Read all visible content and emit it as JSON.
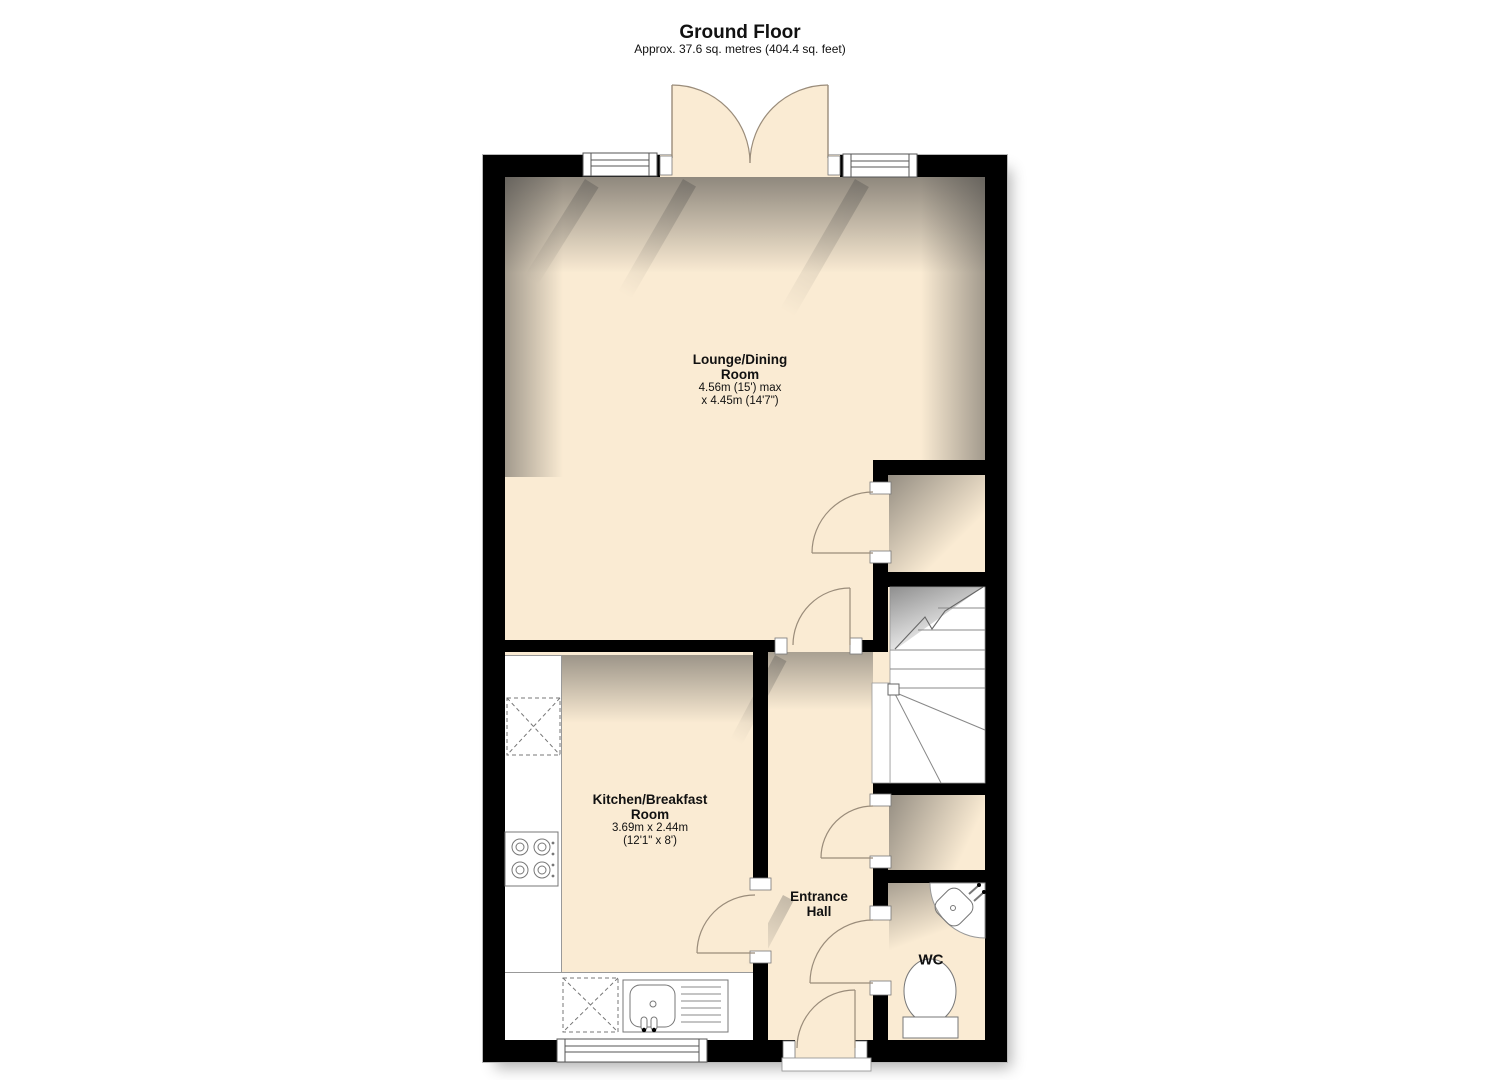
{
  "title": "Ground Floor",
  "subtitle": "Approx. 37.6 sq. metres (404.4 sq. feet)",
  "rooms": {
    "lounge": {
      "name_line1": "Lounge/Dining",
      "name_line2": "Room",
      "dims_line1": "4.56m (15') max",
      "dims_line2": "x 4.45m (14'7\")"
    },
    "kitchen": {
      "name_line1": "Kitchen/Breakfast",
      "name_line2": "Room",
      "dims_line1": "3.69m x 2.44m",
      "dims_line2": "(12'1\" x 8')"
    },
    "entrance_hall": {
      "name_line1": "Entrance",
      "name_line2": "Hall"
    },
    "wc": {
      "name": "WC"
    }
  },
  "fixtures": {
    "french_doors": "french-doors-icon",
    "window": "window-icon",
    "staircase": "staircase-icon",
    "door_swing": "door-swing-icon",
    "hob": "hob-icon",
    "kitchen_sink_drainer": "sink-drainer-icon",
    "appliance_space": "appliance-space-icon",
    "corner_basin": "corner-basin-icon",
    "toilet": "toilet-icon"
  },
  "colors": {
    "wall": "#000000",
    "floor": "#faebd3",
    "fixture_fill": "#ffffff",
    "fixture_line": "#777777",
    "door_arc": "#9a8c7a",
    "shadow": "#5a5a5a"
  }
}
